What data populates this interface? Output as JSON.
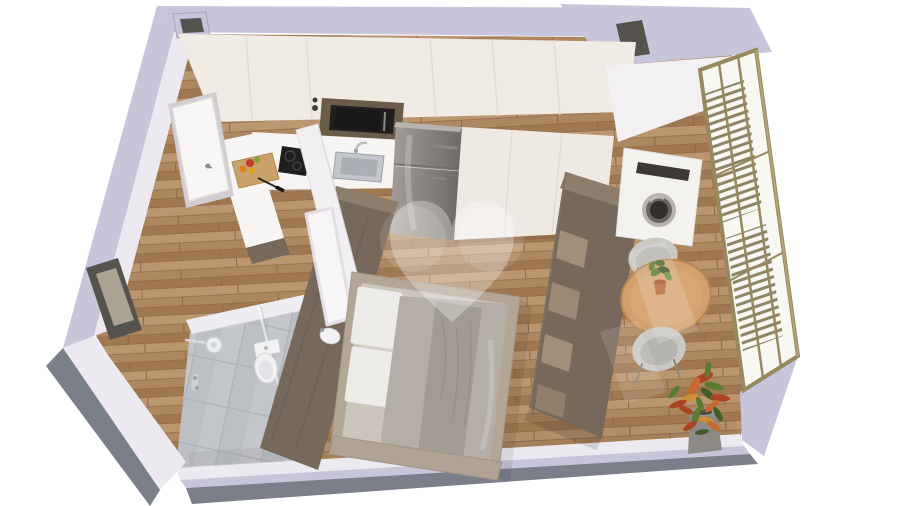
{
  "meta": {
    "title": "3D isometric floor plan render of a studio apartment on a white background",
    "view": "3d-isometric-floor-plan",
    "watermark": "heart-logo-translucent"
  },
  "scene": {
    "rooms": [
      "entry-hall",
      "kitchen",
      "bathroom",
      "sleeping-area",
      "dining-area"
    ],
    "appliances": [
      "microwave-oven",
      "induction-cooktop",
      "kitchen-sink",
      "refrigerator",
      "washing-machine"
    ],
    "furniture": [
      "kitchen-cabinet-run",
      "tall-cabinet-run",
      "peninsula-counter",
      "double-bed",
      "headboard-wood-wall",
      "wall-cabinet",
      "shelving-divider",
      "round-dining-table",
      "dining-chair",
      "dining-chair",
      "vanity-counter"
    ],
    "fixtures": [
      "entrance-door",
      "shower-head",
      "shower-mixer",
      "shower-glass-panel",
      "toilet",
      "vanity-sink",
      "glazed-facade",
      "louvered-shutters",
      "wall-window-opening",
      "service-shaft-northwest",
      "service-shaft-northeast"
    ],
    "decor": [
      "cutting-board-with-vegetables",
      "chef-knife",
      "succulent-table-plant",
      "croton-floor-plant",
      "heart-watermark"
    ],
    "floors": [
      {
        "area": "kitchen-living-dining",
        "material": "wood-planks"
      },
      {
        "area": "bathroom",
        "material": "gray-ceramic-tiles"
      }
    ]
  },
  "colors": {
    "background": "#ffffff",
    "wallTop": "#c7c5d9",
    "wallDark": "#7b7f8a",
    "wallWhite": "#eceaf0",
    "ductDark": "#56534e",
    "cream": "#f1ebe6",
    "creamSeam": "#e2dad2",
    "tallCabinet": "#efe9e4",
    "counter": "#f7f5f3",
    "woodDark": "#76685a",
    "woodDarkTop": "#8d7d6c",
    "nicheWood": "#6b5b49",
    "applianceBlack": "#211f1e",
    "steel": "#c3c7cb",
    "steelDeep": "#a9afb5",
    "bathWall": "#efedf2",
    "fixtureWhite": "#f2f2f4",
    "doorWhite": "#f8f6f5",
    "partition": "#f1eff2",
    "bedFrame": "#b3a697",
    "mattress": "#ccc5bb",
    "pillow": "#edece8",
    "blanket": "#b5aea6",
    "throw": "#a29b93",
    "footRail": "#b0a394",
    "tableWood": "#d2a06e",
    "tableEdge": "#b8864f",
    "chair": "#c9c8c3",
    "chairInner": "#b5b4ae",
    "legBrown": "#8e8476",
    "terracotta": "#b96a3c",
    "potGray": "#8d8984",
    "leafGreen": "#5d7a33",
    "leafDark": "#415c26",
    "leafOrange": "#c76a2b",
    "leafRed": "#ab4423",
    "leafAmber": "#cf8f36",
    "glass": "#f9f7f1",
    "neWall": "#f2f0f2",
    "bronze": "#97885f",
    "bronzeHi": "#b4a478",
    "louver": "#8e8468",
    "washerRing": "#b7b2ac",
    "washerMid": "#6b6560",
    "washerDark": "#312e2b",
    "floorWoodLight": "#bb9670",
    "floorWoodMid": "#ad875f",
    "floorWoodDark": "#9f7852",
    "floorWoodLine": "#8d6846",
    "tile": "#c3c6ca",
    "tileShade": "#bcbfc4",
    "tileGrout": "#aeb1b6",
    "fridgeHi": "#a7a19d",
    "fridgeMid": "#8d8783",
    "fridgeLo": "#6f6a66",
    "watermark": "#ffffff"
  }
}
